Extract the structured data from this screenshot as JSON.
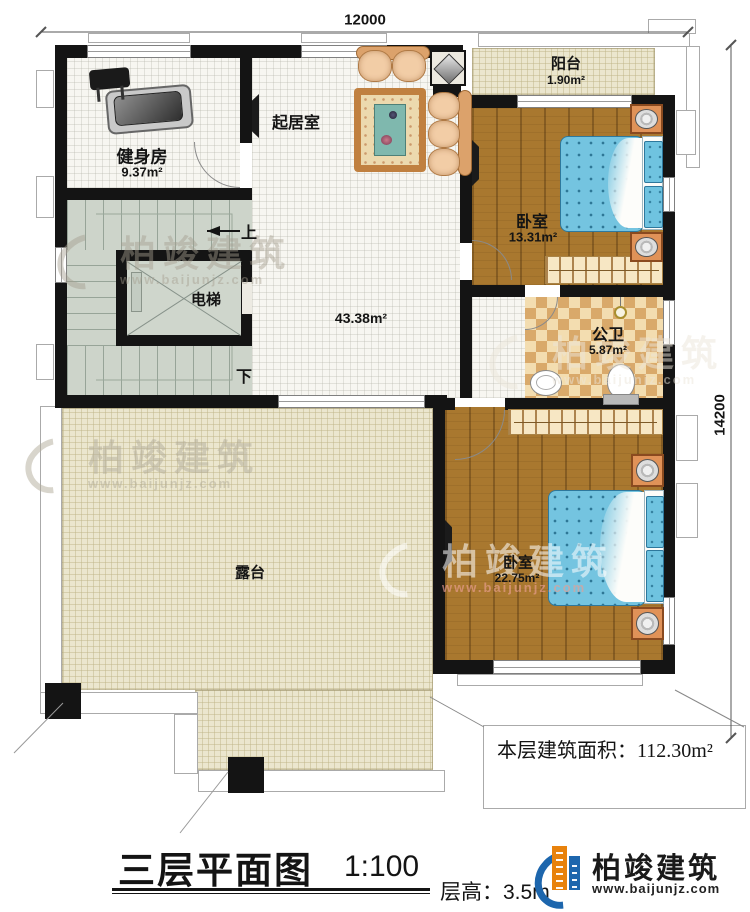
{
  "dimensions": {
    "top": "12000",
    "right": "14200"
  },
  "rooms": {
    "gym": {
      "name": "健身房",
      "area": "9.37m²"
    },
    "living": {
      "name": "起居室",
      "area": "43.38m²"
    },
    "balcony": {
      "name": "阳台",
      "area": "1.90m²"
    },
    "bedroom_top": {
      "name": "卧室",
      "area": "13.31m²"
    },
    "bathroom": {
      "name": "公卫",
      "area": "5.87m²"
    },
    "bedroom_bottom": {
      "name": "卧室",
      "area": "22.75m²"
    },
    "terrace": {
      "name": "露台"
    },
    "elevator": {
      "name": "电梯"
    },
    "stairs": {
      "up": "上",
      "down": "下"
    }
  },
  "annotations": {
    "floor_area": "本层建筑面积：112.30m²",
    "title": "三层平面图",
    "scale": "1:100",
    "floor_height": "层高：3.5m"
  },
  "brand": {
    "name": "柏竣建筑",
    "url": "www.baijunjz.com"
  },
  "watermark": {
    "name": "柏竣建筑",
    "url": "www.baijunjz.com"
  },
  "colors": {
    "wall": "#141414",
    "wood_floor": "#a9782f",
    "bed_blue": "#74c4e0",
    "terrace_tile": "#ebe6ce",
    "stair_floor": "#cdd4ca",
    "checker_dark": "#d9a96a",
    "checker_light": "#f3ddb0",
    "brand_blue": "#1d66ad",
    "brand_orange": "#e8820c"
  }
}
